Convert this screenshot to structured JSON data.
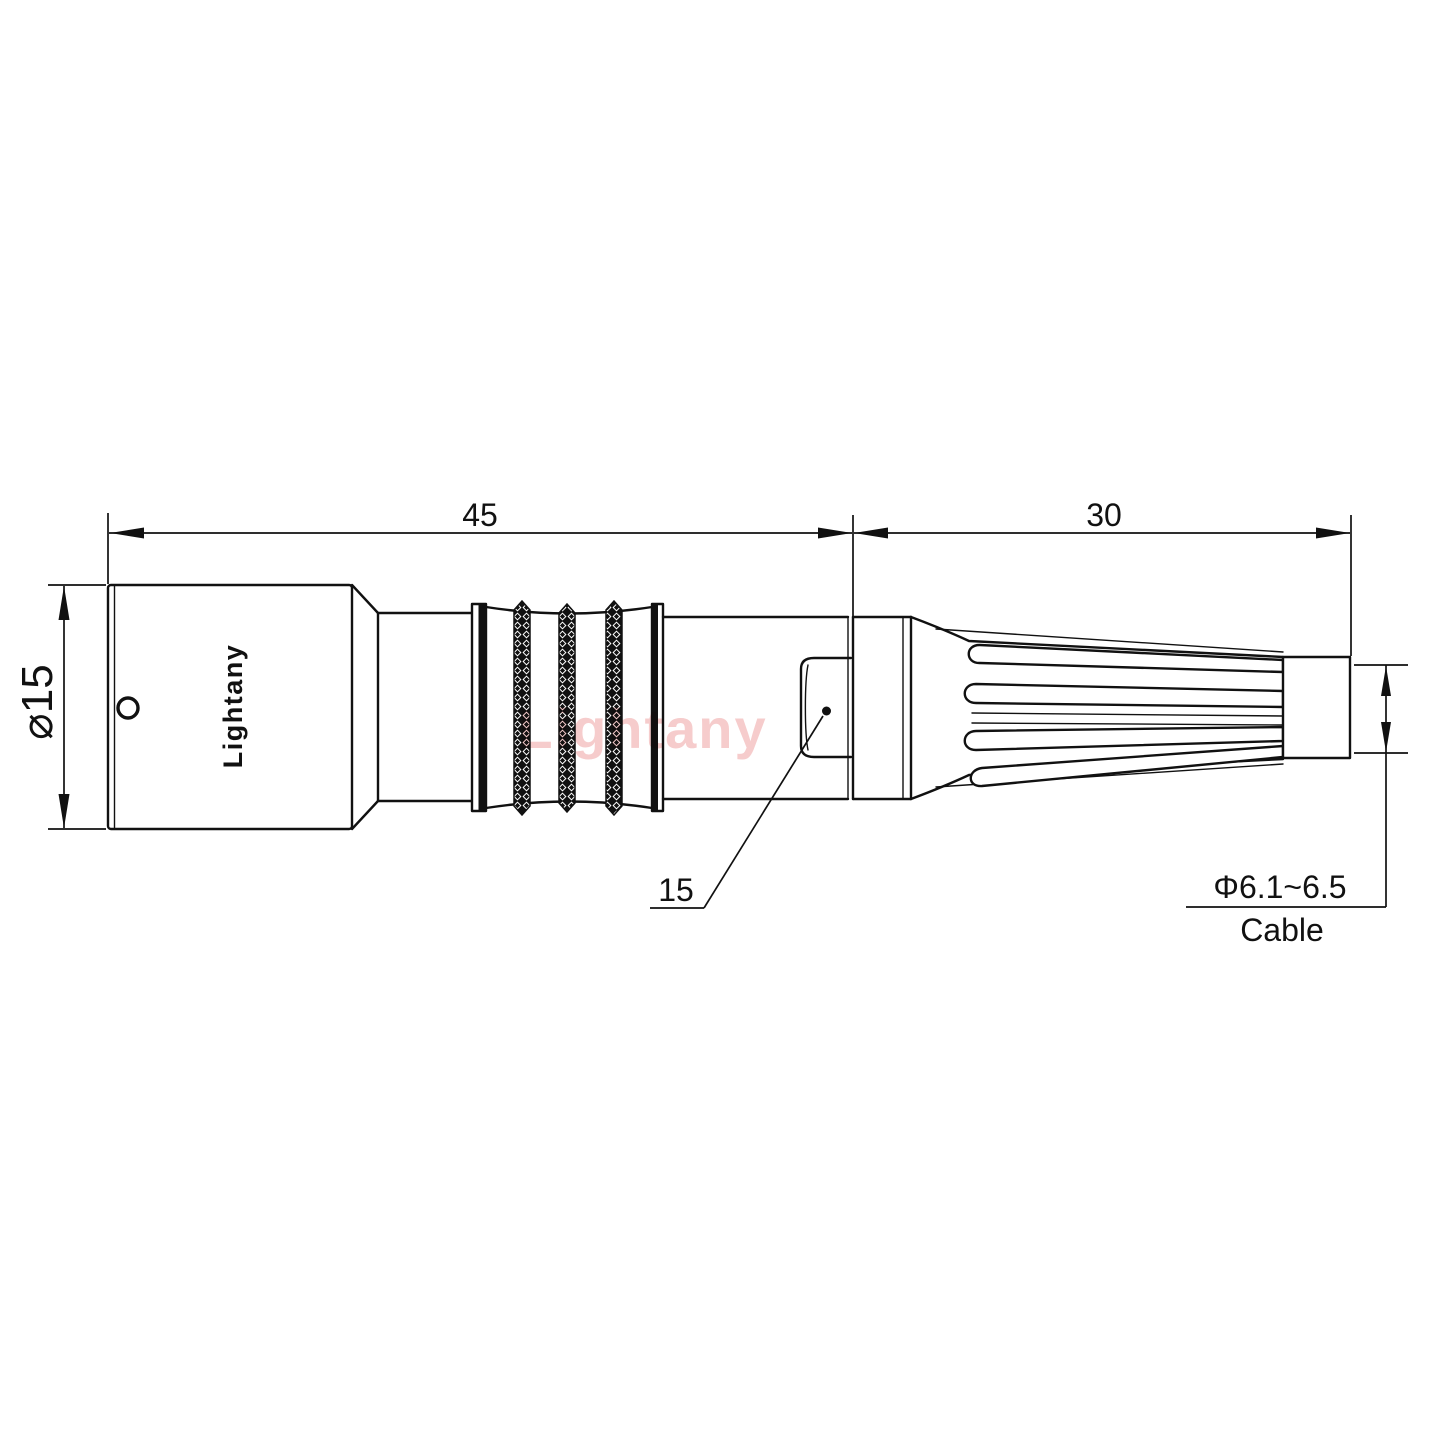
{
  "drawing": {
    "brand": "Lightany",
    "watermark": "Lightany",
    "dimensions": {
      "overall_length": "45",
      "boot_length": "30",
      "body_diameter": "⌀15",
      "release_sleeve_ref": "15",
      "cable_diameter": "Φ6.1~6.5",
      "cable_label": "Cable"
    },
    "colors": {
      "line": "#111111",
      "watermark": "#f6cccc",
      "background": "#ffffff"
    }
  }
}
